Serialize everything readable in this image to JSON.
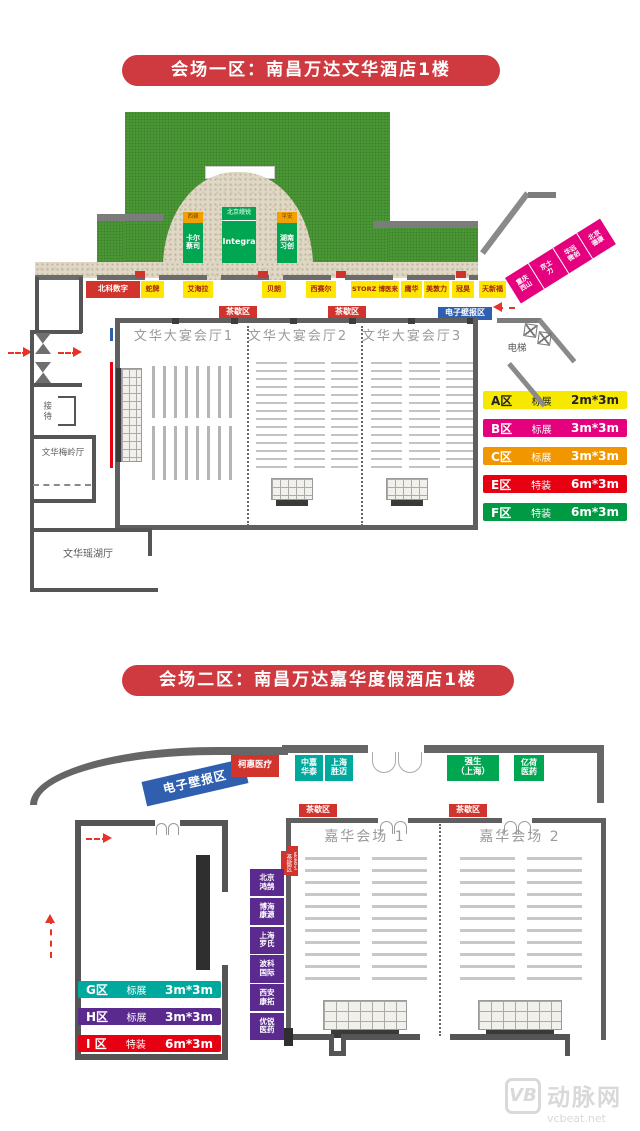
{
  "venue1": {
    "title": "会场一区：南昌万达文华酒店1楼",
    "gate_signs": [
      {
        "top": "西顿",
        "main": "卡尔\n蔡司"
      },
      {
        "top": "北京缦锐",
        "main": "Integra"
      },
      {
        "top": "平安",
        "main": "湖南\n习创"
      }
    ],
    "booth_row": [
      "北科数字",
      "蛇牌",
      "艾海拉",
      "贝朗",
      "西赛尔",
      "STORZ 博医来",
      "鹰华",
      "美敦力",
      "冠昊",
      "天新福"
    ],
    "diagonal_booths": [
      "重庆\n西山",
      "京士\n力",
      "华远\n微创",
      "北京\n德康"
    ],
    "tea_label": "茶歇区",
    "eposter_label": "电子壁报区",
    "halls": [
      "文华大宴会厅1",
      "文华大宴会厅2",
      "文华大宴会厅3"
    ],
    "rooms": {
      "reception": "接待",
      "meiling": "文华梅岭厅",
      "yaohu": "文华瑶湖厅",
      "elevator": "电梯"
    },
    "legend": [
      {
        "zone": "A区",
        "type": "标展",
        "size": "2m*3m",
        "bg": "#f6e800",
        "fg": "#222222"
      },
      {
        "zone": "B区",
        "type": "标展",
        "size": "3m*3m",
        "bg": "#e5007d",
        "fg": "#ffffff"
      },
      {
        "zone": "C区",
        "type": "标展",
        "size": "3m*3m",
        "bg": "#f29600",
        "fg": "#ffffff"
      },
      {
        "zone": "E区",
        "type": "特装",
        "size": "6m*3m",
        "bg": "#e60012",
        "fg": "#ffffff"
      },
      {
        "zone": "F区",
        "type": "特装",
        "size": "6m*3m",
        "bg": "#009a44",
        "fg": "#ffffff"
      }
    ]
  },
  "venue2": {
    "title": "会场二区：南昌万达嘉华度假酒店1楼",
    "eposter_label": "电子壁报区",
    "top_booths": [
      {
        "label": "柯惠医疗"
      },
      {
        "label": "中嘉\n华泰"
      },
      {
        "label": "上海\n胜迈"
      },
      {
        "label": "强生\n（上海）"
      },
      {
        "label": "亿荷\n医药"
      }
    ],
    "tea_label": "茶歇区",
    "side_tag": "茶歇区",
    "halls": [
      "嘉华会场 1",
      "嘉华会场 2"
    ],
    "left_booths": [
      "北京\n鸿鹄",
      "博海\n康源",
      "上海\n罗氏",
      "波科\n国际",
      "西安\n康拓",
      "优锐\n医药"
    ],
    "legend": [
      {
        "zone": "G区",
        "type": "标展",
        "size": "3m*3m",
        "bg": "#00a99d",
        "fg": "#ffffff"
      },
      {
        "zone": "H区",
        "type": "标展",
        "size": "3m*3m",
        "bg": "#5b2a8e",
        "fg": "#ffffff"
      },
      {
        "zone": "I 区",
        "type": "特装",
        "size": "6m*3m",
        "bg": "#e60012",
        "fg": "#ffffff"
      }
    ]
  },
  "watermark": {
    "logo": "VB",
    "name": "动脉网",
    "site": "vcbeat.net"
  },
  "colors": {
    "title_bg": "#ce3a40",
    "lawn": "#4d9c38",
    "stone": "#e0d8c6",
    "wall_gray": "#5f5f5f",
    "booth_yellow": "#ffe500",
    "booth_red": "#d0342c",
    "eposter_blue": "#2f5fae",
    "magenta_strip": "#e5007d",
    "purple_column": "#5b2a8e",
    "teal_booth": "#00a99d",
    "green_booth": "#00a651",
    "arrow_red": "#e8332a"
  }
}
